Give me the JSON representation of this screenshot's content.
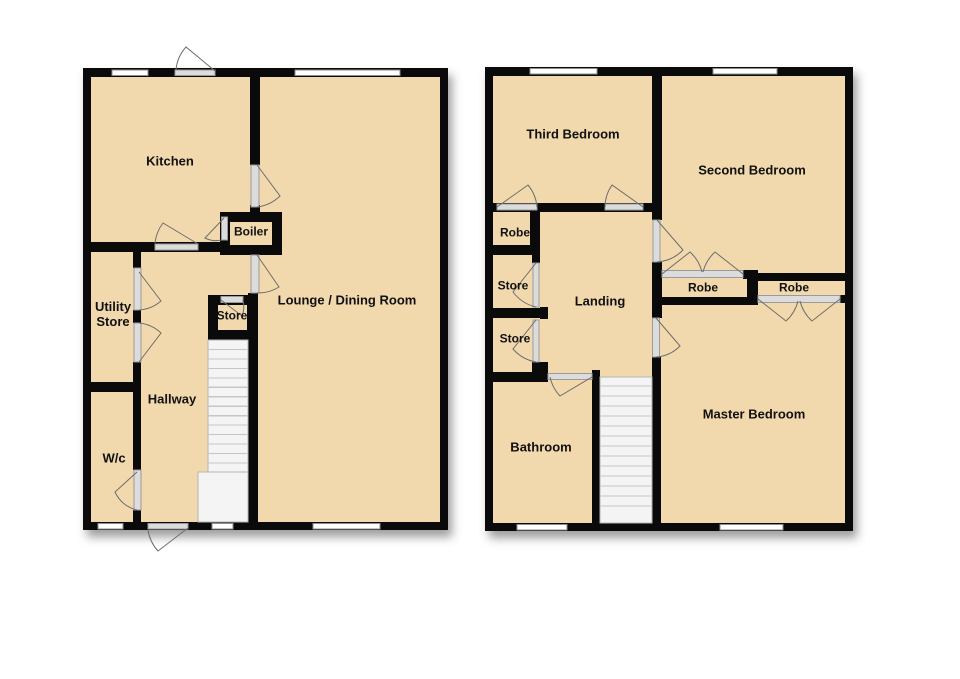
{
  "colors": {
    "room_fill": "#f1d9ad",
    "wall": "#0a0a0a",
    "window_fill": "#ffffff",
    "frame": "#8d8d8d",
    "door_fill": "#dcdcdc",
    "door_edge": "#9a9a9a",
    "arc": "#6e6e6e",
    "stair_fill": "#f4f4f4",
    "stair_line": "#c6c6c6",
    "label": "#111111"
  },
  "plans": [
    {
      "id": "ground-floor",
      "container": "ground-floor-labels",
      "rooms": [
        {
          "id": "kitchen",
          "label": "Kitchen",
          "x": 170,
          "y": 161
        },
        {
          "id": "boiler",
          "label": "Boiler",
          "x": 251,
          "y": 232,
          "size": 12
        },
        {
          "id": "utility-store",
          "label": "Utility\nStore",
          "x": 113,
          "y": 314
        },
        {
          "id": "store",
          "label": "Store",
          "x": 232,
          "y": 316,
          "size": 12
        },
        {
          "id": "hallway",
          "label": "Hallway",
          "x": 172,
          "y": 399
        },
        {
          "id": "wc",
          "label": "W/c",
          "x": 114,
          "y": 458
        },
        {
          "id": "lounge-dining-room",
          "label": "Lounge / Dining Room",
          "x": 347,
          "y": 300
        }
      ]
    },
    {
      "id": "first-floor",
      "container": "first-floor-labels",
      "rooms": [
        {
          "id": "third-bedroom",
          "label": "Third Bedroom",
          "x": 573,
          "y": 134
        },
        {
          "id": "second-bedroom",
          "label": "Second Bedroom",
          "x": 752,
          "y": 170
        },
        {
          "id": "robe-top",
          "label": "Robe",
          "x": 515,
          "y": 233,
          "size": 12
        },
        {
          "id": "store-upper",
          "label": "Store",
          "x": 513,
          "y": 286,
          "size": 12
        },
        {
          "id": "store-lower",
          "label": "Store",
          "x": 515,
          "y": 339,
          "size": 12
        },
        {
          "id": "landing",
          "label": "Landing",
          "x": 600,
          "y": 301
        },
        {
          "id": "bathroom",
          "label": "Bathroom",
          "x": 541,
          "y": 447
        },
        {
          "id": "master-bedroom",
          "label": "Master Bedroom",
          "x": 754,
          "y": 414
        },
        {
          "id": "robe-mid-left",
          "label": "Robe",
          "x": 703,
          "y": 288,
          "size": 12
        },
        {
          "id": "robe-mid-right",
          "label": "Robe",
          "x": 794,
          "y": 288,
          "size": 12
        }
      ]
    }
  ]
}
